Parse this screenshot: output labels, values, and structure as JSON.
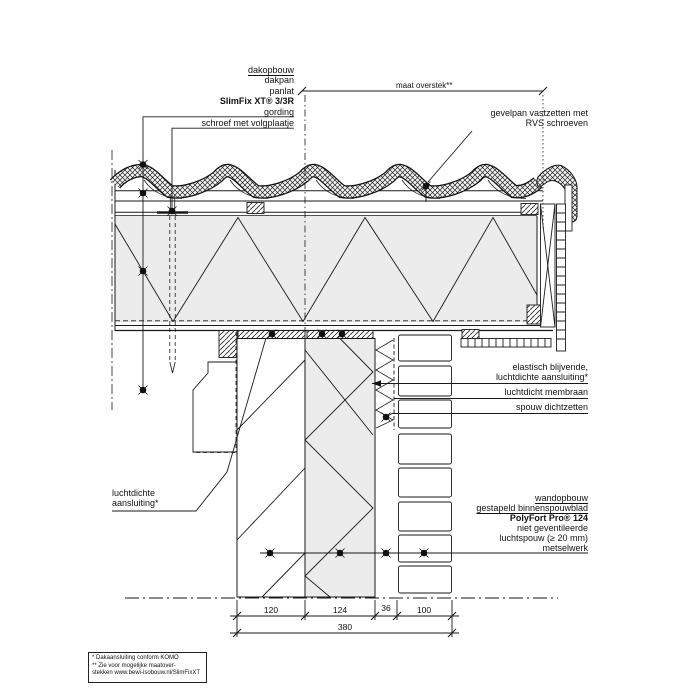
{
  "title_labels": {
    "roof_stack": {
      "title": "dakopbouw",
      "items": [
        "dakpan",
        "panlat",
        "SlimFix XT® 3/3R",
        "gording"
      ]
    },
    "screw": "schroef met volgplaatje",
    "overhang_dim": "maat overstek**",
    "verge_tile": {
      "line1": "gevelpan vastzetten met",
      "line2": "RVS schroeven"
    },
    "elastic_seal": {
      "line1": "elastisch blijvende,",
      "line2": "luchtdichte aansluiting*"
    },
    "membrane": "luchtdicht membraan",
    "cavity_close": "spouw dichtzetten",
    "airtight_left": {
      "line1": "luchtdichte",
      "line2": "aansluiting*"
    },
    "wall_stack": {
      "title": "wandopbouw",
      "items": [
        "gestapeld binnenspouwblad",
        "PolyFort Pro® 124",
        "niet geventileerde",
        "luchtspouw (≥ 20 mm)",
        "metselwerk"
      ]
    }
  },
  "dimensions": {
    "segments": [
      "120",
      "124",
      "36",
      "100"
    ],
    "total": "380"
  },
  "footnotes": {
    "line1": "* Dakaansluiting conform KOMO",
    "line2": "** Zie voor mogelijke maatover-",
    "line3": "stekken www.bewi-isobouw.nl/SlimFixXT"
  },
  "colors": {
    "line": "#1a1a1a",
    "insulation_fill": "#ececec",
    "background": "#ffffff"
  }
}
